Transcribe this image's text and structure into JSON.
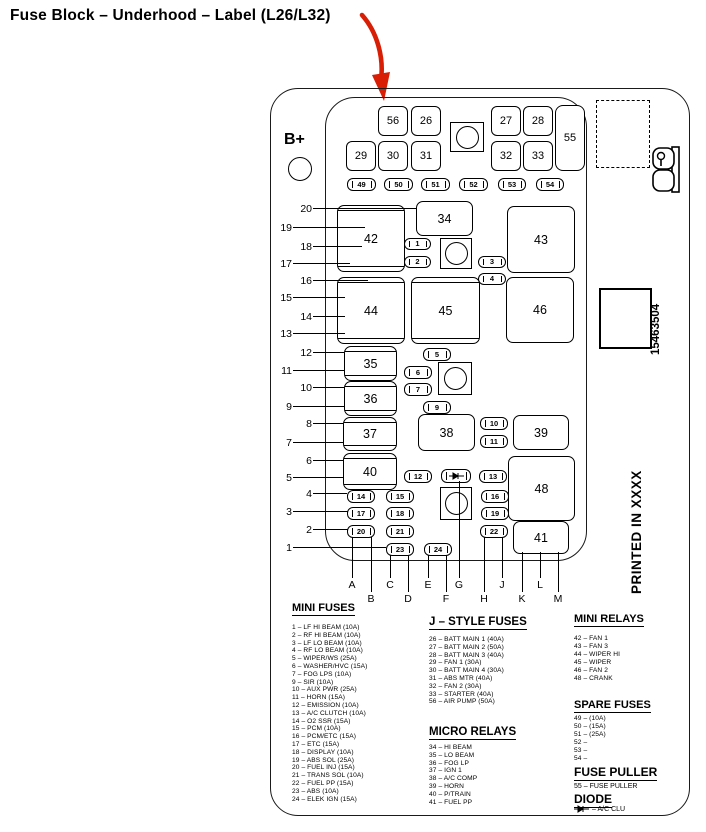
{
  "title": "Fuse Block – Underhood – Label (L26/L32)",
  "colors": {
    "arrow": "#d81e05",
    "line": "#000000",
    "background": "#ffffff"
  },
  "label": {
    "b_plus": "B+",
    "part_number": "15463504",
    "printed_in": "PRINTED IN XXXX"
  },
  "pins": [
    "20",
    "19",
    "18",
    "17",
    "16",
    "15",
    "14",
    "13",
    "12",
    "11",
    "10",
    "9",
    "8",
    "7",
    "6",
    "5",
    "4",
    "3",
    "2",
    "1"
  ],
  "columns": [
    "A",
    "B",
    "C",
    "D",
    "E",
    "F",
    "G",
    "H",
    "J",
    "K",
    "L",
    "M"
  ],
  "fuses": {
    "f56": "56",
    "f26": "26",
    "f27": "27",
    "f28": "28",
    "f29": "29",
    "f30": "30",
    "f31": "31",
    "f32": "32",
    "f33": "33",
    "f55": "55",
    "o49": "49",
    "o50": "50",
    "o51": "51",
    "o52": "52",
    "o53": "53",
    "o54": "54",
    "r42": "42",
    "r34": "34",
    "r43": "43",
    "r44": "44",
    "r45": "45",
    "r46": "46",
    "b35": "35",
    "b36": "36",
    "b37": "37",
    "b40": "40",
    "r38": "38",
    "r39": "39",
    "r48": "48",
    "r41": "41",
    "o1": "1",
    "o2": "2",
    "o3": "3",
    "o4": "4",
    "o5": "5",
    "o6": "6",
    "o7": "7",
    "o9": "9",
    "o10": "10",
    "o11": "11",
    "o12": "12",
    "o13": "13",
    "o14": "14",
    "o15": "15",
    "o16": "16",
    "o17": "17",
    "o18": "18",
    "o19": "19",
    "o20": "20",
    "o21": "21",
    "o22": "22",
    "o23": "23",
    "o24": "24"
  },
  "legend": {
    "mini_fuses": {
      "heading": "MINI FUSES",
      "items": [
        "1 – LF HI BEAM (10A)",
        "2 – RF HI BEAM (10A)",
        "3 – LF LO BEAM (10A)",
        "4 – RF LO BEAM (10A)",
        "5 – WIPER/WS (25A)",
        "6 – WASHER/HVC (15A)",
        "7 – FOG LPS (10A)",
        "9 – SIR (10A)",
        "10 – AUX PWR (25A)",
        "11 – HORN (15A)",
        "12 – EMISSION (10A)",
        "13 – A/C CLUTCH (10A)",
        "14 – O2 SSR (15A)",
        "15 – PCM (10A)",
        "16 – PCM/ETC (15A)",
        "17 – ETC (15A)",
        "18 – DISPLAY (10A)",
        "19 – ABS SOL (25A)",
        "20 – FUEL INJ (15A)",
        "21 – TRANS SOL (10A)",
        "22 – FUEL PP (15A)",
        "23 – ABS (10A)",
        "24 – ELEK IGN (15A)"
      ]
    },
    "j_style_fuses": {
      "heading": "J – STYLE FUSES",
      "items": [
        "26 – BATT MAIN 1 (40A)",
        "27 – BATT MAIN 2 (50A)",
        "28 – BATT MAIN 3 (40A)",
        "29 – FAN 1 (30A)",
        "30 – BATT MAIN 4 (30A)",
        "31 – ABS MTR (40A)",
        "32 – FAN 2 (30A)",
        "33 – STARTER (40A)",
        "56 – AIR PUMP (50A)"
      ]
    },
    "micro_relays": {
      "heading": "MICRO RELAYS",
      "items": [
        "34 – HI BEAM",
        "35 – LO BEAM",
        "36 – FOG LP",
        "37 – IGN 1",
        "38 – A/C COMP",
        "39 – HORN",
        "40 – P/TRAIN",
        "41 – FUEL PP"
      ]
    },
    "mini_relays": {
      "heading": "MINI RELAYS",
      "items": [
        "42 – FAN 1",
        "43 – FAN 3",
        "44 – WIPER HI",
        "45 – WIPER",
        "46 – FAN 2",
        "48 – CRANK"
      ]
    },
    "spare_fuses": {
      "heading": "SPARE FUSES",
      "items": [
        "49 – (10A)",
        "50 – (15A)",
        "51 – (25A)",
        "52 –",
        "53 –",
        "54 –"
      ]
    },
    "fuse_puller": {
      "heading": "FUSE PULLER",
      "item": "55 – FUSE PULLER"
    },
    "diode": {
      "heading": "DIODE",
      "label": "– A/C CLU"
    }
  }
}
